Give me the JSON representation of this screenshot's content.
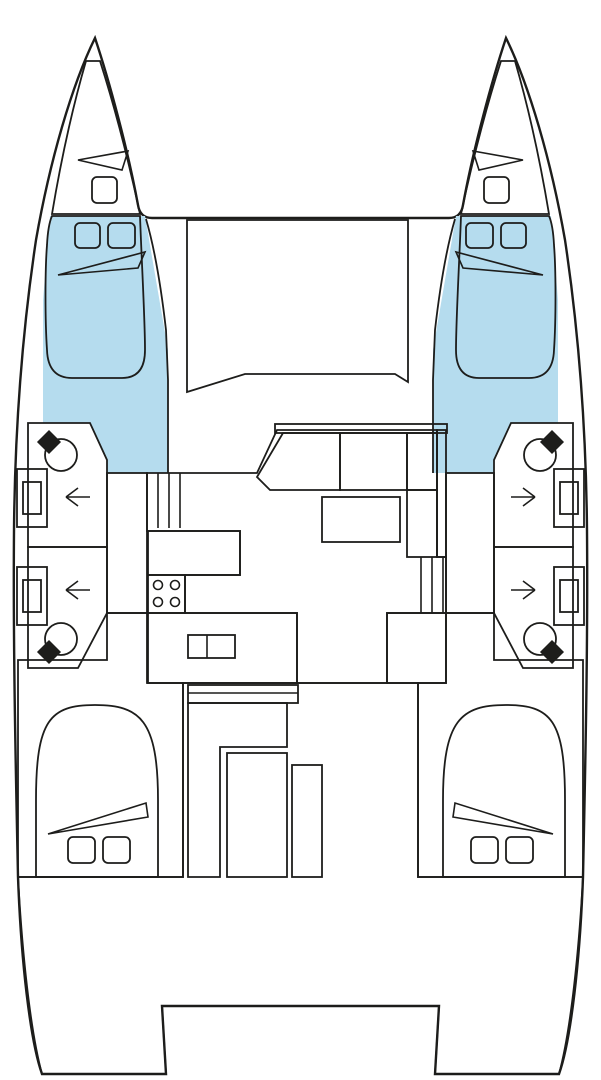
{
  "diagram": {
    "type": "boat-floor-plan",
    "subject": "catamaran-interior-layout-top-view",
    "orientation": "bow-up",
    "palette": {
      "outline": "#1d1d1b",
      "hull_white": "#ffffff",
      "cabin_floor_blue": "#b5dcee",
      "berth_blue": "#9fc4d0",
      "forepeak_blue": "#c4d6db",
      "bathroom_green": "#d3da8c",
      "salon_yellow": "#fedd8e",
      "deck_tan": "#ccb39c",
      "fixture_black": "#1d1d1b"
    },
    "regions": [
      {
        "id": "hull-silhouette",
        "label": "catamaran hull silhouette",
        "color_key": "hull_white"
      },
      {
        "id": "foredeck-window",
        "label": "coachroof front window / foredeck panel",
        "color_key": "hull_white"
      },
      {
        "id": "port-forepeak",
        "label": "port forepeak locker",
        "color_key": "forepeak_blue"
      },
      {
        "id": "starboard-forepeak",
        "label": "starboard forepeak locker",
        "color_key": "forepeak_blue"
      },
      {
        "id": "port-forward-berth",
        "label": "port forward cabin berth",
        "color_key": "berth_blue"
      },
      {
        "id": "starboard-forward-berth",
        "label": "starboard forward cabin berth",
        "color_key": "berth_blue"
      },
      {
        "id": "port-bathroom-forward",
        "label": "port forward bathroom",
        "color_key": "bathroom_green"
      },
      {
        "id": "port-bathroom-aft",
        "label": "port aft bathroom",
        "color_key": "bathroom_green"
      },
      {
        "id": "starboard-bathroom-forward",
        "label": "starboard forward bathroom",
        "color_key": "bathroom_green"
      },
      {
        "id": "starboard-bathroom-aft",
        "label": "starboard aft bathroom",
        "color_key": "bathroom_green"
      },
      {
        "id": "salon",
        "label": "salon / galley bridgedeck",
        "color_key": "salon_yellow"
      },
      {
        "id": "port-passage",
        "label": "port hull passageway",
        "color_key": "salon_yellow"
      },
      {
        "id": "starboard-passage",
        "label": "starboard hull passageway",
        "color_key": "salon_yellow"
      },
      {
        "id": "port-aft-cabin",
        "label": "port aft cabin",
        "color_key": "cabin_floor_blue"
      },
      {
        "id": "starboard-aft-cabin",
        "label": "starboard aft cabin",
        "color_key": "cabin_floor_blue"
      },
      {
        "id": "port-aft-berth",
        "label": "port aft berth",
        "color_key": "berth_blue"
      },
      {
        "id": "starboard-aft-berth",
        "label": "starboard aft berth",
        "color_key": "berth_blue"
      },
      {
        "id": "cockpit-deck",
        "label": "aft cockpit and transom deck",
        "color_key": "deck_tan"
      }
    ],
    "fixtures": [
      {
        "id": "basin",
        "label": "wash basin with tap",
        "count": 4
      },
      {
        "id": "wc",
        "label": "marine toilet",
        "count": 4
      },
      {
        "id": "door-arrow",
        "label": "bathroom entry arrow",
        "count": 4
      },
      {
        "id": "companionway-steps",
        "label": "steps down to hull",
        "count": 2
      },
      {
        "id": "settee",
        "label": "L-shaped salon settee",
        "count": 1
      },
      {
        "id": "salon-table",
        "label": "salon table",
        "count": 1
      },
      {
        "id": "galley-counter",
        "label": "galley counters",
        "count": 2
      },
      {
        "id": "stove",
        "label": "4-burner stove",
        "count": 1
      },
      {
        "id": "sink",
        "label": "double galley sink",
        "count": 1
      },
      {
        "id": "cockpit-bench",
        "label": "cockpit bench seating",
        "count": 2
      },
      {
        "id": "cockpit-table",
        "label": "cockpit table",
        "count": 1
      },
      {
        "id": "deck-hatch",
        "label": "deck hatch",
        "count": 10
      },
      {
        "id": "berth-pillow",
        "label": "berth pillow marker",
        "count": 6
      }
    ]
  }
}
